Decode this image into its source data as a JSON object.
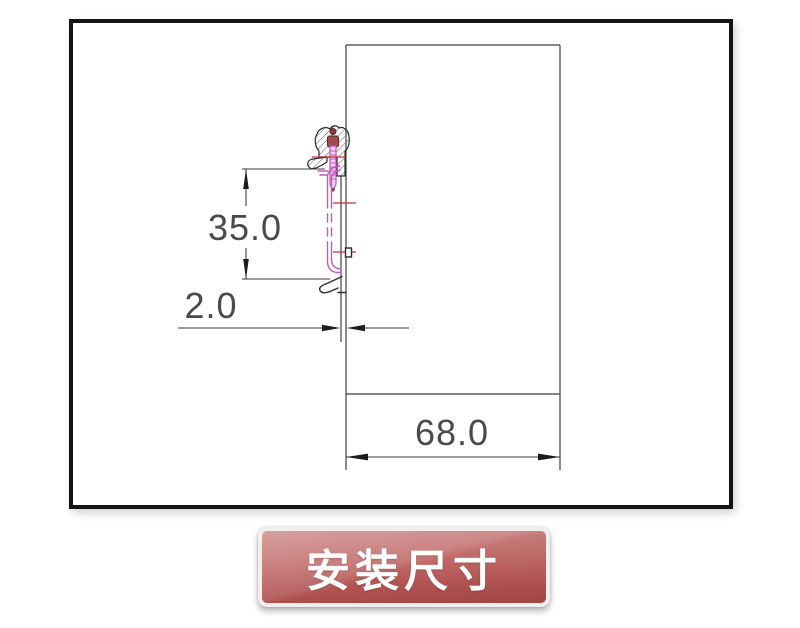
{
  "diagram": {
    "dim_vertical": "35.0",
    "dim_gap": "2.0",
    "dim_width": "68.0"
  },
  "caption": {
    "text": "安装尺寸"
  },
  "colors": {
    "drawing_line": "#3f3f3f",
    "rail_magenta": "#c554c5",
    "centerline_red": "#cc2f2f",
    "screw_head_maroon": "#a04a49",
    "banner_red_top": "#c67b79",
    "banner_red_bottom": "#aa4a48",
    "banner_text": "#ffffff",
    "frame_border": "#141414"
  }
}
